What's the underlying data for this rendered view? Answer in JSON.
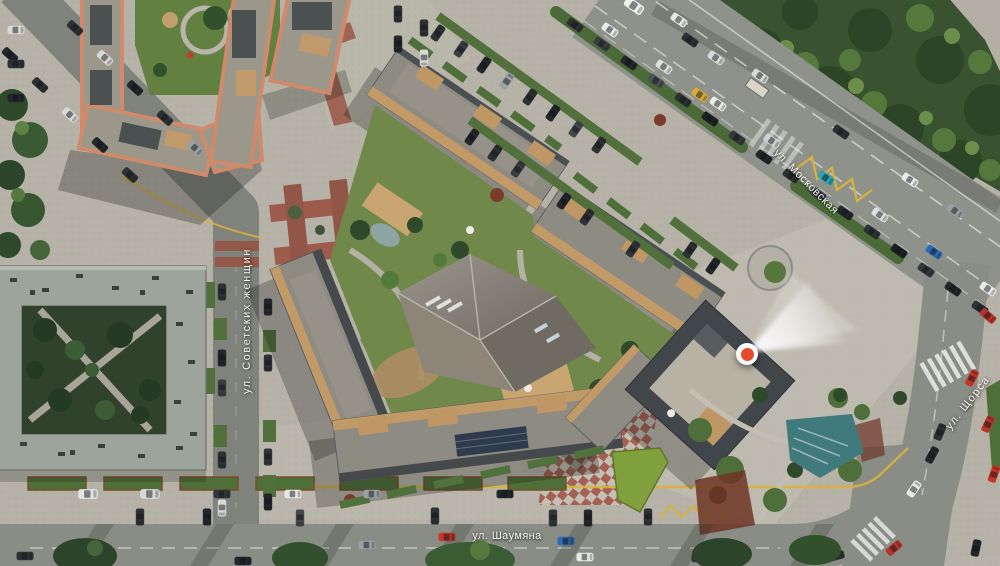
{
  "map": {
    "kind": "aerial-masterplan-render",
    "streets": {
      "sovetskikh": {
        "label": "ул. Советских женщин"
      },
      "shaumyana": {
        "label": "ул. Шаумяна"
      },
      "moskovskaya": {
        "label": "ул. Московская"
      },
      "shchorsa": {
        "label": "ул. Щорса"
      }
    },
    "marker": {
      "kind": "location-pin",
      "color": "#e84a2e",
      "beam_direction": "northeast"
    },
    "palette": {
      "pavement": "#b6b2a8",
      "asphalt": "#8a8d85",
      "forest": "#39522f",
      "roof_gray": "#8e8b82",
      "roof_terracotta_edge": "#cf8a6b",
      "wood_deck": "#c29a68",
      "red_paving": "#99503f",
      "teal_steps": "#417a7c",
      "lawn": "#70884a",
      "marking_yellow": "#d9b23c"
    }
  }
}
